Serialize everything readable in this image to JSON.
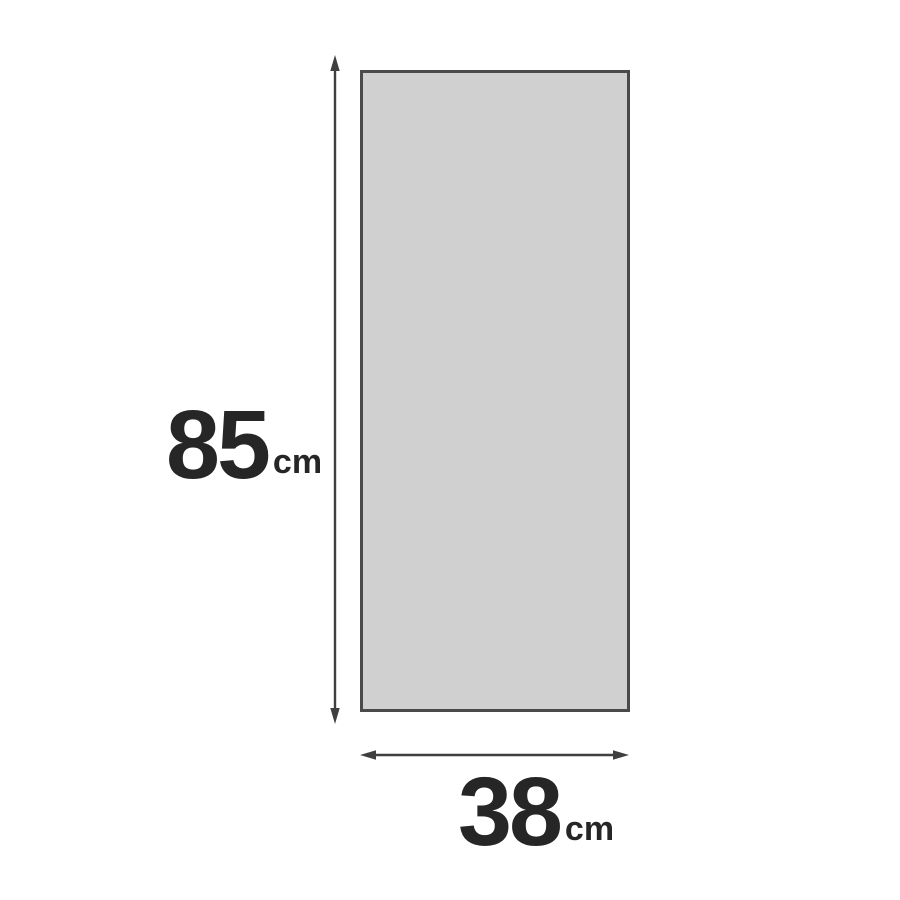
{
  "diagram": {
    "type": "dimension-diagram",
    "shape": "rectangle",
    "height_dimension": {
      "value": "85",
      "unit": "cm"
    },
    "width_dimension": {
      "value": "38",
      "unit": "cm"
    },
    "colors": {
      "background": "#ffffff",
      "rect_fill": "#d0d0d0",
      "rect_border": "#4a4a4a",
      "arrow": "#3f3f3f",
      "label_text": "#262626"
    }
  }
}
